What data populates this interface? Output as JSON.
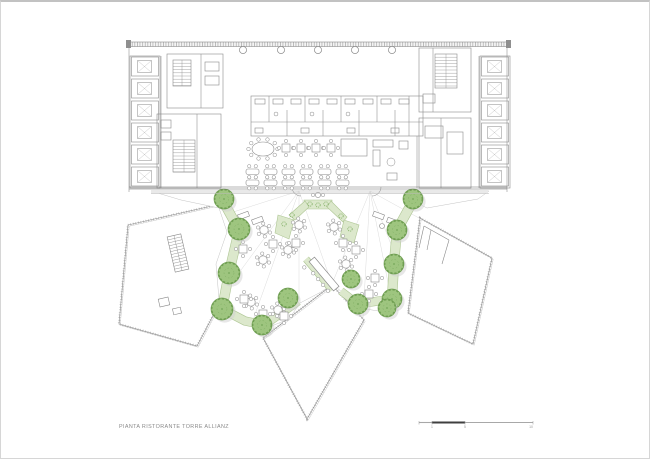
{
  "page": {
    "caption": "PIANTA RISTORANTE TORRE ALLIANZ"
  },
  "scale_bar": {
    "y": 420.5,
    "segments": [
      {
        "x1": 418,
        "x2": 431,
        "dark": false
      },
      {
        "x1": 431,
        "x2": 464,
        "dark": true
      },
      {
        "x1": 464,
        "x2": 532,
        "dark": false
      }
    ],
    "labels": [
      {
        "text": "1",
        "x": 431
      },
      {
        "text": "5",
        "x": 464
      },
      {
        "text": "10",
        "x": 530
      }
    ]
  },
  "colors": {
    "line": "#8a8a8a",
    "line_light": "#b9b9b9",
    "line_faint": "#d2d2d2",
    "glass": "#6f6f6f",
    "solid": "#8f8f8f",
    "tree_fill": "#9ec57f",
    "tree_stroke": "#6f9e52",
    "tree_inner": "#7fae63",
    "planter_fill": "#dce8cc",
    "planter_edge": "#aec694",
    "shadow": "#cfcfcf",
    "walk": "#e9e9e9",
    "scale_dark": "#3f3f3f",
    "scale_gray": "#a8a8a8",
    "text_gray": "#9a9a9a"
  },
  "building": {
    "outline_rects": [
      [
        129,
        54,
        30,
        132
      ],
      [
        479,
        54,
        30,
        132
      ],
      [
        166,
        52,
        56,
        54
      ],
      [
        156,
        112,
        64,
        74
      ],
      [
        250,
        94,
        172,
        40
      ],
      [
        418,
        46,
        52,
        64
      ],
      [
        418,
        116,
        52,
        70
      ],
      [
        340,
        137,
        26,
        17
      ],
      [
        372,
        138,
        20,
        7
      ],
      [
        372,
        148,
        7,
        16
      ],
      [
        398,
        139,
        9,
        8
      ],
      [
        386,
        171,
        10,
        7
      ],
      [
        204,
        60,
        14,
        9
      ],
      [
        204,
        74,
        14,
        9
      ],
      [
        160,
        118,
        10,
        8
      ],
      [
        160,
        130,
        10,
        8
      ],
      [
        422,
        92,
        12,
        9
      ],
      [
        424,
        124,
        18,
        12
      ],
      [
        446,
        130,
        16,
        22
      ],
      [
        254,
        97,
        10,
        5
      ],
      [
        272,
        97,
        10,
        5
      ],
      [
        290,
        97,
        10,
        5
      ],
      [
        308,
        97,
        10,
        5
      ],
      [
        326,
        97,
        10,
        5
      ],
      [
        344,
        97,
        10,
        5
      ],
      [
        362,
        97,
        10,
        5
      ],
      [
        380,
        97,
        10,
        5
      ],
      [
        398,
        97,
        10,
        5
      ],
      [
        254,
        126,
        8,
        5
      ],
      [
        300,
        126,
        8,
        5
      ],
      [
        346,
        126,
        8,
        5
      ],
      [
        390,
        126,
        8,
        5
      ]
    ],
    "solid_rects": [
      [
        125,
        38,
        5,
        8
      ],
      [
        505,
        38,
        5,
        8
      ]
    ],
    "top_band": [
      128,
      40,
      378,
      4.5
    ],
    "lines": [
      [
        160,
        54,
        160,
        186
      ],
      [
        478,
        54,
        478,
        186
      ],
      [
        128,
        40,
        128,
        190
      ],
      [
        506,
        40,
        506,
        190
      ],
      [
        200,
        52,
        200,
        106
      ],
      [
        196,
        112,
        196,
        186
      ],
      [
        432,
        46,
        432,
        110
      ],
      [
        440,
        116,
        440,
        186
      ],
      [
        268,
        94,
        268,
        120
      ],
      [
        286,
        108,
        286,
        134
      ],
      [
        304,
        94,
        304,
        120
      ],
      [
        322,
        108,
        322,
        134
      ],
      [
        340,
        94,
        340,
        120
      ],
      [
        358,
        108,
        358,
        134
      ],
      [
        376,
        94,
        376,
        120
      ],
      [
        394,
        108,
        394,
        134
      ],
      [
        408,
        94,
        408,
        134
      ],
      [
        250,
        120,
        422,
        120
      ],
      [
        416,
        134,
        416,
        186
      ]
    ],
    "glass_lines": [
      [
        128,
        185,
        506,
        185
      ],
      [
        128,
        187,
        506,
        187
      ]
    ],
    "walk_line": [
      150,
      191.5,
      488,
      191.5
    ],
    "columns": {
      "xs": [
        242,
        280,
        317,
        354,
        391
      ],
      "y": 48,
      "r": 3.6
    },
    "small_circles": [
      [
        275,
        112,
        2
      ],
      [
        311,
        112,
        2
      ],
      [
        347,
        112,
        2
      ],
      [
        390,
        160,
        4
      ]
    ],
    "door_arcs": [
      "M291,185 A9 9 0 0 0 300,194",
      "M380,185 A9 9 0 0 1 371,194"
    ],
    "stairs": [
      {
        "x": 172,
        "y": 58,
        "w": 18,
        "h": 26,
        "step": 3.2,
        "rot": 0
      },
      {
        "x": 172,
        "y": 138,
        "w": 22,
        "h": 32,
        "step": 3.2,
        "rot": 0
      },
      {
        "x": 434,
        "y": 52,
        "w": 22,
        "h": 34,
        "step": 3.2,
        "rot": 0
      }
    ],
    "elevator_banks": [
      {
        "x": 130.5,
        "y": 55,
        "cells": 6,
        "cw": 27,
        "ch": 19,
        "gap": 22
      },
      {
        "x": 480.5,
        "y": 55,
        "cells": 6,
        "cw": 27,
        "ch": 19,
        "gap": 22
      }
    ],
    "dining": {
      "oval": {
        "cx": 262,
        "cy": 147,
        "rx": 11,
        "ry": 7,
        "chairs": 10
      },
      "square_tables": [
        [
          285,
          146
        ],
        [
          300,
          146
        ],
        [
          315,
          146
        ],
        [
          330,
          146
        ]
      ],
      "rows": {
        "ys": [
          167,
          178
        ],
        "x0": 245,
        "dx": 18,
        "n": 6,
        "tw": 13,
        "th": 5.5
      }
    }
  },
  "terrace": {
    "floor": [
      [
        150,
        189
      ],
      [
        488,
        189
      ],
      [
        477,
        197
      ],
      [
        426,
        206
      ],
      [
        412,
        199
      ],
      [
        398,
        224
      ],
      [
        394,
        262
      ],
      [
        391,
        300
      ],
      [
        384,
        310
      ],
      [
        358,
        306
      ],
      [
        341,
        290
      ],
      [
        331,
        282
      ],
      [
        320,
        290
      ],
      [
        299,
        301
      ],
      [
        288,
        317
      ],
      [
        263,
        327
      ],
      [
        241,
        321
      ],
      [
        219,
        309
      ],
      [
        215,
        262
      ],
      [
        226,
        230
      ],
      [
        218,
        206
      ],
      [
        180,
        198
      ]
    ],
    "guides": [
      [
        298,
        189,
        226,
        212
      ],
      [
        298,
        189,
        240,
        268
      ],
      [
        298,
        189,
        252,
        318
      ],
      [
        298,
        189,
        298,
        299
      ],
      [
        298,
        189,
        331,
        282
      ],
      [
        369,
        189,
        418,
        216
      ],
      [
        369,
        189,
        397,
        260
      ],
      [
        369,
        189,
        390,
        296
      ],
      [
        369,
        189,
        362,
        316
      ],
      [
        369,
        189,
        331,
        282
      ]
    ],
    "planter_paths": [
      {
        "d": "M222,199 L238,228 L228,271 L221,307",
        "w": 9
      },
      {
        "d": "M221,307 L244,319 L263,323",
        "w": 8
      },
      {
        "d": "M263,323 L297,299",
        "w": 8
      },
      {
        "d": "M412,199 L396,228 L393,261 L391,297",
        "w": 9
      },
      {
        "d": "M391,297 L357,302",
        "w": 8
      },
      {
        "d": "M357,302 L340,289",
        "w": 7
      },
      {
        "d": "M305,257 L331,288",
        "w": 6
      }
    ],
    "planter_polys": [
      [
        [
          303,
          198
        ],
        [
          331,
          198
        ],
        [
          331,
          207
        ],
        [
          303,
          207
        ]
      ],
      [
        [
          288,
          213
        ],
        [
          304,
          199
        ],
        [
          308,
          205
        ],
        [
          294,
          218
        ]
      ],
      [
        [
          330,
          199
        ],
        [
          346,
          215
        ],
        [
          342,
          220
        ],
        [
          326,
          205
        ]
      ],
      [
        [
          277,
          213
        ],
        [
          293,
          218
        ],
        [
          288,
          237
        ],
        [
          274,
          231
        ]
      ],
      [
        [
          343,
          218
        ],
        [
          358,
          223
        ],
        [
          353,
          241
        ],
        [
          339,
          235
        ]
      ]
    ],
    "tufts": [
      [
        309,
        202
      ],
      [
        317,
        203
      ],
      [
        325,
        202
      ],
      [
        291,
        213
      ],
      [
        340,
        214
      ],
      [
        283,
        222
      ],
      [
        349,
        227
      ]
    ],
    "trees": [
      {
        "x": 223,
        "y": 197,
        "r": 10
      },
      {
        "x": 412,
        "y": 197,
        "r": 10
      },
      {
        "x": 238,
        "y": 227,
        "r": 11
      },
      {
        "x": 396,
        "y": 228,
        "r": 10
      },
      {
        "x": 228,
        "y": 271,
        "r": 11
      },
      {
        "x": 393,
        "y": 262,
        "r": 10
      },
      {
        "x": 221,
        "y": 307,
        "r": 11
      },
      {
        "x": 391,
        "y": 297,
        "r": 10
      },
      {
        "x": 261,
        "y": 323,
        "r": 10
      },
      {
        "x": 287,
        "y": 296,
        "r": 10
      },
      {
        "x": 357,
        "y": 302,
        "r": 10
      },
      {
        "x": 386,
        "y": 306,
        "r": 9
      },
      {
        "x": 350,
        "y": 277,
        "r": 9
      }
    ],
    "round_tables": [
      [
        263,
        228
      ],
      [
        298,
        223
      ],
      [
        333,
        225
      ],
      [
        262,
        258
      ],
      [
        287,
        248
      ],
      [
        345,
        262
      ],
      [
        250,
        300
      ],
      [
        277,
        308
      ]
    ],
    "square_tables": [
      [
        242,
        247
      ],
      [
        272,
        242
      ],
      [
        295,
        241
      ],
      [
        342,
        241
      ],
      [
        355,
        248
      ],
      [
        243,
        297
      ],
      [
        262,
        312
      ],
      [
        283,
        314
      ],
      [
        374,
        276
      ],
      [
        368,
        292
      ]
    ],
    "duo_tables": [
      [
        317,
        193
      ]
    ],
    "lounge_rects": [
      [
        237,
        211,
        11,
        5,
        -20
      ],
      [
        251,
        216,
        11,
        5,
        -20
      ],
      [
        372,
        211,
        11,
        5,
        20
      ],
      [
        386,
        217,
        11,
        5,
        20
      ]
    ],
    "lounge_circles": [
      [
        246,
        224,
        2.5
      ],
      [
        381,
        224,
        2.5
      ]
    ],
    "counter": {
      "poly": [
        [
          308.1,
          259.7
        ],
        [
          332.5,
          288.9
        ],
        [
          338,
          284.3
        ],
        [
          313.5,
          255.1
        ]
      ],
      "stools": [
        [
          303.3,
          265.4
        ],
        [
          312.2,
          271.3
        ],
        [
          317.1,
          277.1
        ],
        [
          322,
          282.9
        ],
        [
          326.9,
          288.8
        ]
      ]
    }
  },
  "petals": [
    {
      "pts": [
        [
          127,
          223
        ],
        [
          224,
          201
        ],
        [
          236,
          268
        ],
        [
          196,
          344
        ],
        [
          118,
          322
        ]
      ]
    },
    {
      "pts": [
        [
          331,
          283
        ],
        [
          363,
          318
        ],
        [
          306,
          417
        ],
        [
          262,
          336
        ]
      ]
    },
    {
      "pts": [
        [
          419,
          216
        ],
        [
          491,
          256
        ],
        [
          472,
          342
        ],
        [
          407,
          311
        ]
      ]
    }
  ],
  "petal_details": {
    "stairs": [
      {
        "x": 170,
        "y": 233,
        "w": 14,
        "h": 36,
        "step": 3,
        "rot": -13
      }
    ],
    "rects": [
      [
        158,
        296,
        10,
        8,
        -13
      ],
      [
        172,
        306,
        8,
        6,
        -13
      ]
    ],
    "lines": [
      [
        423,
        224,
        448,
        238
      ],
      [
        448,
        238,
        441,
        262
      ],
      [
        423,
        224,
        418,
        246
      ],
      [
        430,
        228,
        426,
        248
      ]
    ]
  }
}
